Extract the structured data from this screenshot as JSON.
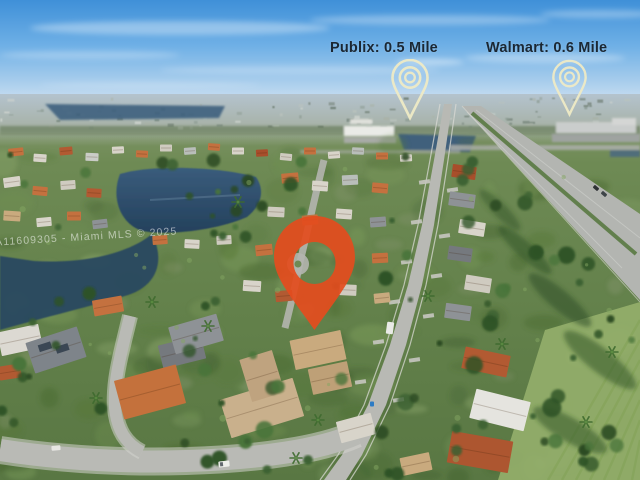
{
  "annotations": {
    "publix": {
      "label": "Publix: 0.5 Mile"
    },
    "walmart": {
      "label": "Walmart: 0.6 Mile"
    }
  },
  "watermark": {
    "text": "A11609305 - Miami MLS © 2025"
  },
  "colors": {
    "label_text": "#1B2733",
    "poi_pin_outline": "#EFEAC6",
    "property_pin": "#E34C1E",
    "sky": "#4E9ADD",
    "water": "#2C4A61"
  }
}
